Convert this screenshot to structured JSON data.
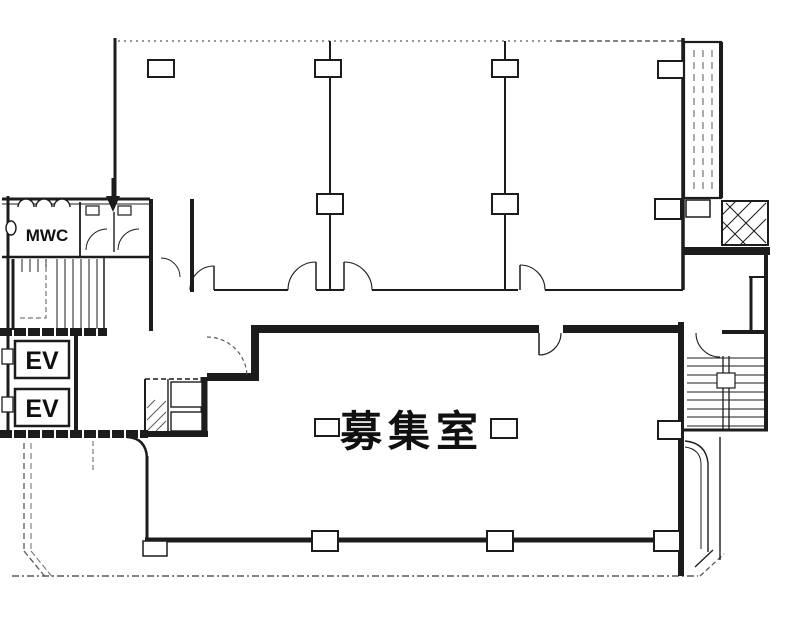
{
  "plan": {
    "type": "building-floor-plan",
    "labels": {
      "restroom": "MWC",
      "elevator_upper": "EV",
      "elevator_lower": "EV",
      "vacant_room": "募集室"
    },
    "colors": {
      "ink": "#1c1c1c",
      "faint": "#5a5a5a",
      "paper": "#ffffff"
    }
  }
}
